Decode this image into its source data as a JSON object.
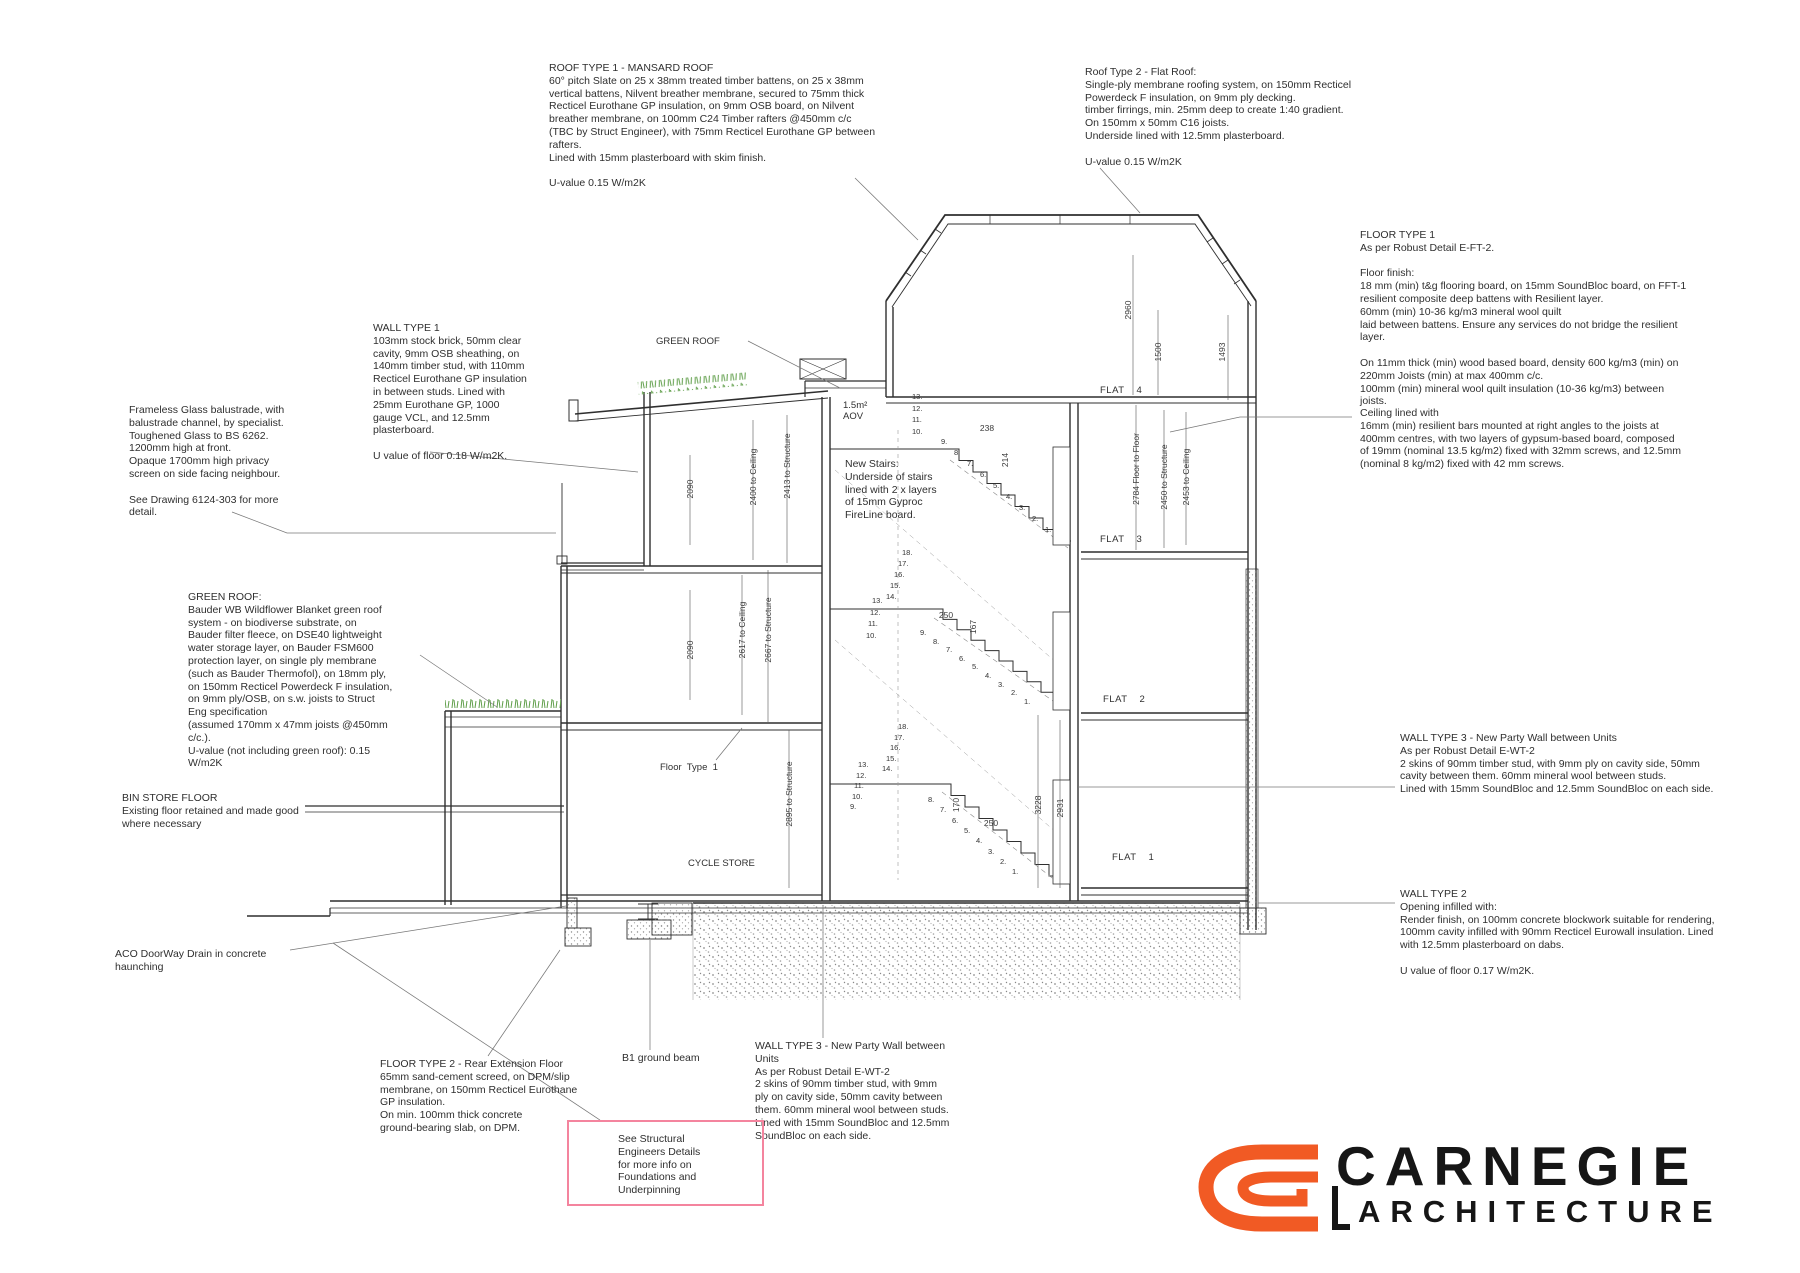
{
  "annotations": {
    "roof1": {
      "text": "ROOF TYPE 1 - MANSARD ROOF\n60° pitch Slate on 25 x 38mm treated timber battens, on 25 x 38mm\nvertical battens, Nilvent breather membrane, secured to 75mm thick\nRecticel Eurothane GP insulation, on 9mm OSB board, on Nilvent\nbreather membrane, on 100mm C24 Timber rafters @450mm c/c\n(TBC by Struct Engineer), with 75mm Recticel Eurothane GP between\nrafters.\nLined with 15mm plasterboard with skim finish.\n\nU-value 0.15 W/m2K"
    },
    "roof2": {
      "text": "Roof Type 2 - Flat Roof:\nSingle-ply membrane roofing system, on 150mm Recticel\nPowerdeck F insulation, on 9mm ply decking.\ntimber firrings, min. 25mm deep to create 1:40 gradient.\nOn 150mm x 50mm C16 joists.\nUnderside lined with 12.5mm plasterboard.\n\nU-value 0.15 W/m2K"
    },
    "floor1": {
      "text": "FLOOR TYPE 1\nAs per Robust Detail E-FT-2.\n\nFloor finish:\n18 mm (min) t&g flooring board, on 15mm SoundBloc board, on FFT-1\nresilient composite deep battens with Resilient layer.\n60mm (min) 10-36 kg/m3 mineral wool quilt\nlaid between battens. Ensure any services do not bridge the resilient\nlayer.\n\nOn 11mm thick (min) wood based board, density 600 kg/m3 (min) on\n220mm Joists (min) at max 400mm c/c.\n100mm (min) mineral wool quilt insulation (10-36 kg/m3) between\njoists."
    },
    "ceiling": {
      "text": "Ceiling lined with\n16mm (min) resilient bars mounted at right angles to the joists at\n400mm centres, with two layers of gypsum-based board, composed\nof 19mm (nominal 13.5 kg/m2) fixed with 32mm screws, and 12.5mm\n(nominal 8 kg/m2) fixed with 42 mm screws."
    },
    "wall1": {
      "text": "WALL TYPE 1\n103mm stock brick, 50mm clear\ncavity, 9mm OSB sheathing, on\n140mm timber stud, with 110mm\nRecticel Eurothane GP insulation\nin between studs. Lined with\n25mm Eurothane GP, 1000\ngauge VCL, and 12.5mm\nplasterboard.\n\nU value of floor 0.18 W/m2K."
    },
    "balustrade": {
      "text": "Frameless Glass balustrade, with\nbalustrade channel, by specialist.\nToughened Glass to BS 6262.\n1200mm high at front.\nOpaque 1700mm high privacy\nscreen on side facing neighbour.\n\nSee Drawing 6124-303 for more\ndetail."
    },
    "greenroof": {
      "text": "GREEN ROOF:\nBauder WB Wildflower Blanket green roof\nsystem - on biodiverse substrate, on\nBauder filter fleece, on DSE40 lightweight\nwater storage layer, on Bauder FSM600\nprotection layer, on single ply membrane\n(such as Bauder Thermofol), on 18mm ply,\non 150mm Recticel Powerdeck F insulation,\non 9mm ply/OSB, on s.w. joists to Struct\nEng specification\n(assumed 170mm x 47mm joists @450mm\nc/c.).\nU-value (not including green roof): 0.15\nW/m2K"
    },
    "binstore": {
      "text": "BIN STORE FLOOR\nExisting floor retained and made good\nwhere necessary"
    },
    "aco": {
      "text": "ACO DoorWay Drain in concrete\nhaunching"
    },
    "floor2": {
      "text": "FLOOR TYPE 2 - Rear Extension Floor\n65mm sand-cement screed, on DPM/slip\nmembrane, on 150mm Recticel Eurothane\nGP insulation.\nOn min. 100mm thick concrete\nground-bearing slab, on DPM."
    },
    "b1": {
      "text": "B1 ground beam"
    },
    "wt3bottom": {
      "text": "WALL TYPE 3 - New Party Wall between\nUnits\nAs per Robust Detail E-WT-2\n2 skins of 90mm timber stud, with 9mm\nply on cavity side, 50mm cavity between\nthem. 60mm mineral wool between studs.\nLined with 15mm SoundBloc and 12.5mm\nSoundBloc on each side."
    },
    "structnote": {
      "text": "See Structural\nEngineers Details\nfor more info on\nFoundations and\nUnderpinning"
    },
    "wt3right": {
      "text": "WALL TYPE 3 - New Party Wall between Units\nAs per Robust Detail E-WT-2\n2 skins of 90mm timber stud, with 9mm ply on cavity side, 50mm\ncavity between them. 60mm mineral wool between studs.\nLined with 15mm SoundBloc and 12.5mm SoundBloc on each side."
    },
    "wt2right": {
      "text": "WALL TYPE 2\nOpening infilled with:\nRender finish, on 100mm concrete blockwork suitable for rendering,\n100mm cavity infilled with 90mm Recticel Eurowall insulation. Lined\nwith 12.5mm plasterboard on dabs.\n\nU value of floor 0.17 W/m2K."
    },
    "newstairs": {
      "text": "New Stairs:\nUnderside of stairs\nlined with  2 x layers\nof 15mm Gyproc\nFireLine board."
    },
    "aov": {
      "text": "1.5m²\nAOV"
    }
  },
  "labels": {
    "greenroof_label": "GREEN ROOF",
    "floor_label": "Floor  Type  1",
    "cycle": "CYCLE STORE",
    "flats": [
      "FLAT 4",
      "FLAT 3",
      "FLAT 2",
      "FLAT 1"
    ]
  },
  "dims": {
    "mansard": [
      "2960",
      "1500",
      "1493"
    ],
    "leftA": [
      "2090",
      "2400 to Ceiling",
      "2413 to Structure"
    ],
    "leftB": [
      "2090",
      "2617 to Ceiling",
      "2667 to Structure"
    ],
    "leftG": [
      "2895 to Structure"
    ],
    "rightA": [
      "2784 Floor to Floor",
      "2450 to Structure",
      "2453 to Ceiling"
    ],
    "rightG": [
      "3228",
      "2931"
    ],
    "small": [
      "238",
      "214",
      "250",
      "167",
      "170",
      "250"
    ]
  },
  "stairs": {
    "flightA_top": [
      "13.",
      "12.",
      "11.",
      "10."
    ],
    "flightA": [
      "9.",
      "8.",
      "7.",
      "6.",
      "5.",
      "4.",
      "3.",
      "2.",
      "1."
    ],
    "landB": [
      "18.",
      "17.",
      "16.",
      "15.",
      "14."
    ],
    "flightB_top": [
      "13.",
      "12.",
      "11.",
      "10."
    ],
    "flightB": [
      "9.",
      "8.",
      "7.",
      "6.",
      "5.",
      "4.",
      "3.",
      "2.",
      "1."
    ],
    "landC": [
      "18.",
      "17.",
      "16.",
      "15.",
      "14."
    ],
    "flightC_top": [
      "13.",
      "12.",
      "11.",
      "10.",
      "9."
    ],
    "flightC": [
      "8.",
      "7.",
      "6.",
      "5.",
      "4.",
      "3.",
      "2.",
      "1."
    ]
  },
  "logo": {
    "name": "CARNEGIE",
    "tagline": "ARCHITECTURE"
  },
  "colors": {
    "line": "#2f2f2f",
    "leader": "#777777",
    "green_roof": "#5f9e49",
    "pink_box": "#f4849e",
    "logo_orange": "#f15a24",
    "logo_black": "#161616"
  }
}
